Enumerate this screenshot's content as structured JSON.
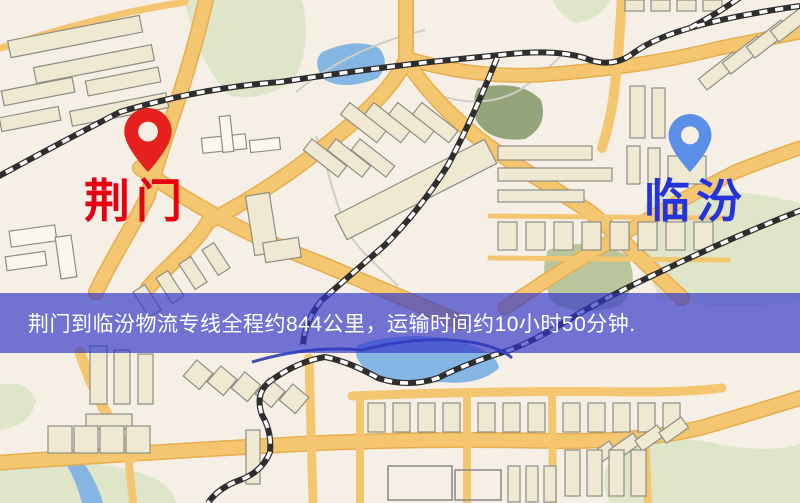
{
  "map": {
    "origin": {
      "name": "荆门",
      "pin_color": "#e5201d",
      "label_color": "#e60012"
    },
    "destination": {
      "name": "临汾",
      "pin_color": "#5b8fe8",
      "label_color": "#2533da"
    },
    "banner": {
      "text": "荆门到临汾物流专线全程约844公里，运输时间约10小时50分钟.",
      "distance": "844公里",
      "duration": "10小时50分钟",
      "background": "#3237c8",
      "text_color": "#ffffff"
    },
    "palette": {
      "land": "#f5efe6",
      "road": "#f5c670",
      "park": "#dfe5c9",
      "park_dark": "#95a57b",
      "water": "#85b5e3",
      "building": "#efe9d2",
      "building_stroke": "#8d8d85",
      "railway": "#2e2e2e"
    }
  }
}
